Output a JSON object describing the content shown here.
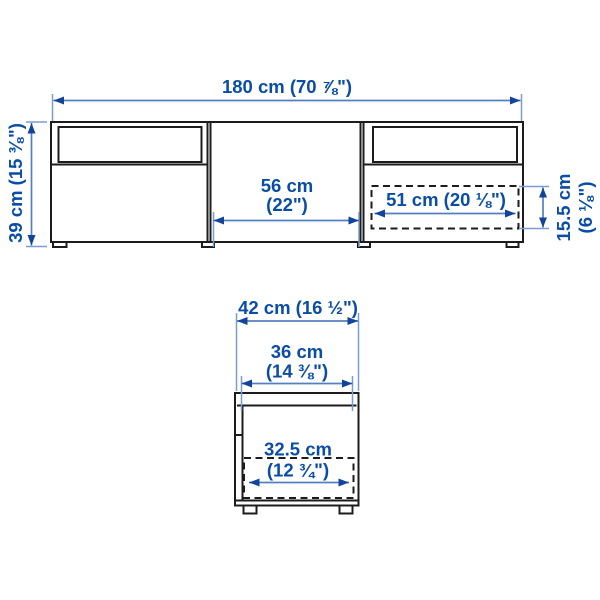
{
  "diagram": {
    "type": "furniture-dimension-illustration",
    "colors": {
      "background": "#ffffff",
      "outline": "#1c1c1c",
      "dimension_line": "#567fc0",
      "extension_line": "#7b9cd3",
      "arrowhead": "#12449c",
      "text": "#0a4da6"
    },
    "labels": {
      "total_width": "180 cm (70 ⅞\")",
      "height": "39 cm (15 ⅜\")",
      "middle_width_1": "56 cm",
      "middle_width_2": "(22\")",
      "drawer_front_width": "51 cm (20 ⅛\")",
      "drawer_front_height_1": "15.5 cm",
      "drawer_front_height_2": "(6 ⅛\")",
      "depth": "42 cm (16 ½\")",
      "inner_depth_1": "36 cm",
      "inner_depth_2": "(14 ⅜\")",
      "drawer_depth_1": "32.5 cm",
      "drawer_depth_2": "(12 ¾\")"
    }
  }
}
